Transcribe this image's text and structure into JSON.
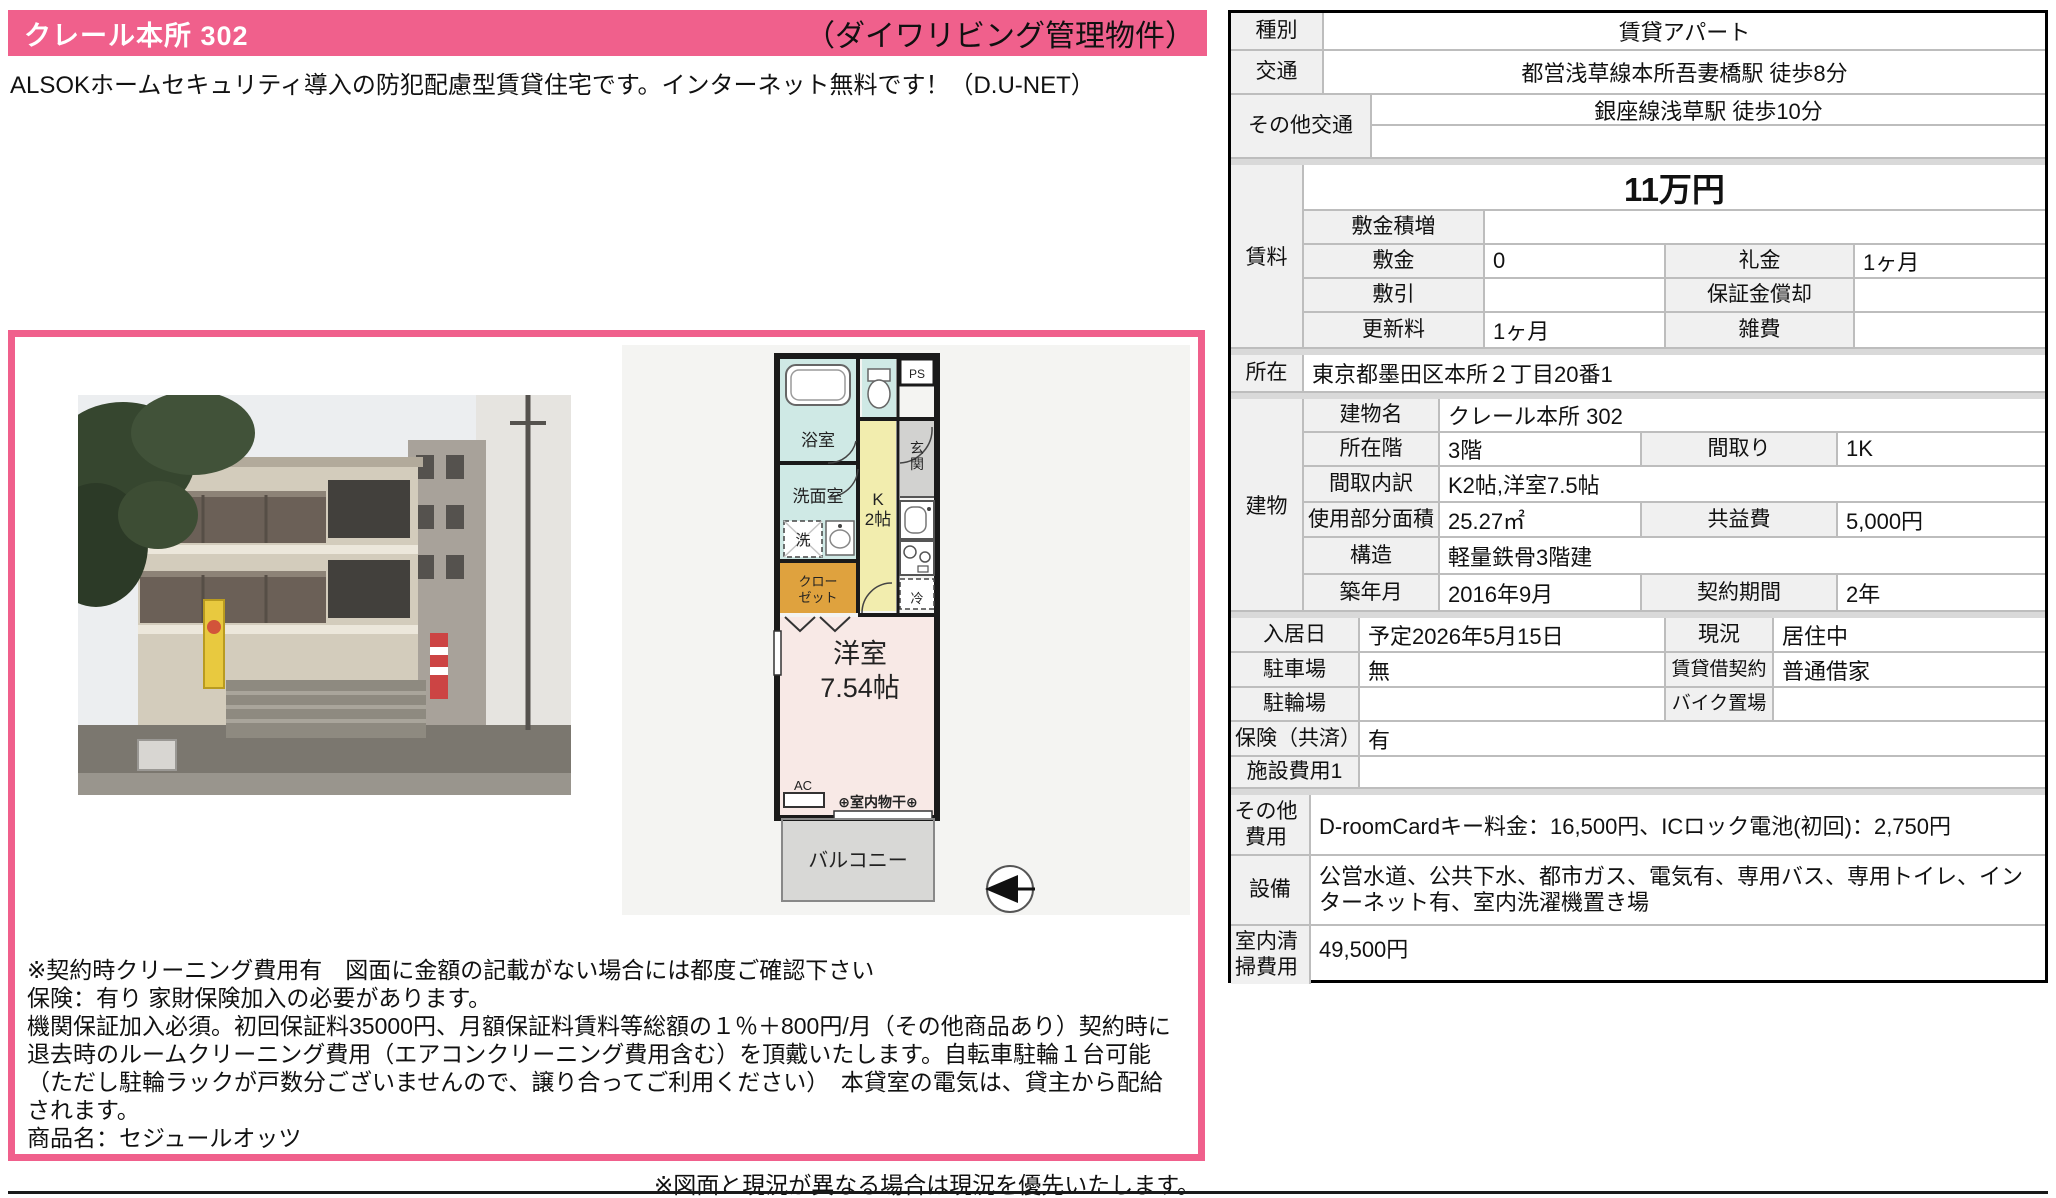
{
  "colors": {
    "pink": "#f0608c",
    "label_bg": "#f0f0f0",
    "grid": "#bdbdbd"
  },
  "header": {
    "title": "クレール本所 302",
    "management": "（ダイワリビング管理物件）"
  },
  "description": "ALSOKホームセキュリティ導入の防犯配慮型賃貸住宅です。インターネット無料です！（D.U-NET）",
  "notes": "※契約時クリーニング費用有　図面に金額の記載がない場合には都度ご確認下さい\n保険：有り 家財保険加入の必要があります。\n機関保証加入必須。初回保証料35000円、月額保証料賃料等総額の１％＋800円/月（その他商品あり）契約時に退去時のルームクリーニング費用（エアコンクリーニング費用含む）を頂戴いたします。自転車駐輪１台可能（ただし駐輪ラックが戸数分ございませんので、譲り合ってご利用ください）　本貸室の電気は、貸主から配給されます。\n商品名：セジュールオッツ",
  "footer_note": "※図面と現況が異なる場合は現況を優先いたします。",
  "floorplan": {
    "bath": "浴室",
    "ps": "PS",
    "genkan_1": "玄",
    "genkan_2": "関",
    "senmen": "洗面室",
    "sen": "洗",
    "k_1": "K",
    "k_2": "2帖",
    "closet_1": "クロー",
    "closet_2": "ゼット",
    "rei": "冷",
    "room_1": "洋室",
    "room_2": "7.54帖",
    "ac": "AC",
    "monohoshi": "⊕室内物干⊕",
    "balcony": "バルコニー"
  },
  "table": {
    "shubetsu_l": "種別",
    "shubetsu": "賃貸アパート",
    "kotsu_l": "交通",
    "kotsu": "都営浅草線本所吾妻橋駅 徒歩8分",
    "sonota_kotsu_l": "その他交通",
    "sonota_kotsu": "銀座線浅草駅 徒歩10分",
    "sonota_kotsu2": "",
    "chinryo_l": "賃料",
    "yachin": "11万円",
    "tsumimashi_l": "敷金積増",
    "tsumimashi": "",
    "shikikin_l": "敷金",
    "shikikin": "0",
    "reikin_l": "礼金",
    "reikin": "1ヶ月",
    "shikibiki_l": "敷引",
    "shikibiki": "",
    "shokyaku_l": "保証金償却",
    "shokyaku": "",
    "koshin_l": "更新料",
    "koshin": "1ヶ月",
    "zappi_l": "雑費",
    "zappi": "",
    "shozai_l": "所在",
    "shozai": "東京都墨田区本所２丁目20番1",
    "tatemono_l": "建物",
    "tatemono_mei_l": "建物名",
    "tatemono_mei": "クレール本所 302",
    "shozaikai_l": "所在階",
    "shozaikai": "3階",
    "madori_l": "間取り",
    "madori": "1K",
    "uchiwake_l": "間取内訳",
    "uchiwake": "K2帖,洋室7.5帖",
    "menseki_l": "使用部分面積",
    "menseki": "25.27㎡",
    "kyoeki_l": "共益費",
    "kyoeki": "5,000円",
    "kozo_l": "構造",
    "kozo": "軽量鉄骨3階建",
    "chiku_l": "築年月",
    "chiku": "2016年9月",
    "kikan_l": "契約期間",
    "kikan": "2年",
    "nyukyo_l": "入居日",
    "nyukyo": "予定2026年5月15日",
    "genkyo_l": "現況",
    "genkyo": "居住中",
    "chusha_l": "駐車場",
    "chusha": "無",
    "keiyaku_l": "賃貸借契約",
    "keiyaku": "普通借家",
    "churin_l": "駐輪場",
    "churin": "",
    "bike_l": "バイク置場",
    "bike": "",
    "hoken_l": "保険（共済）",
    "hoken": "有",
    "shisetsu_l": "施設費用1",
    "shisetsu": "",
    "sonota_l": "その他費用",
    "sonota": "D-roomCardキー料金：16,500円、ICロック電池(初回)：2,750円",
    "setsubi_l": "設備",
    "setsubi": "公営水道、公共下水、都市ガス、電気有、専用バス、専用トイレ、インターネット有、室内洗濯機置き場",
    "seiso_l": "室内清掃費用",
    "seiso": "49,500円"
  }
}
